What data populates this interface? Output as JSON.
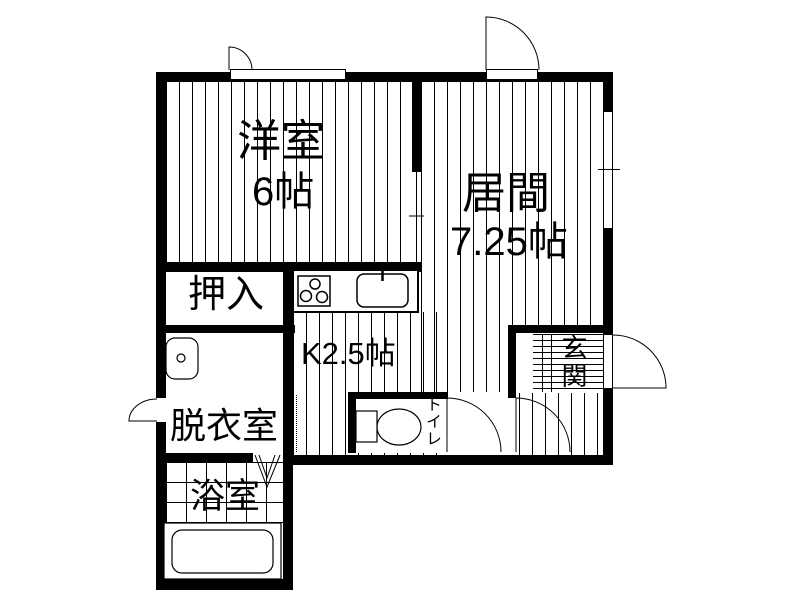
{
  "plan": {
    "type": "japanese-apartment-floor-plan",
    "rooms": {
      "western_room": {
        "label": "洋室",
        "size": "6帖"
      },
      "living_room": {
        "label": "居間",
        "size": "7.25帖"
      },
      "closet": {
        "label": "押入"
      },
      "kitchen": {
        "label": "K2.5帖"
      },
      "dressing_room": {
        "label": "脱衣室"
      },
      "bathroom": {
        "label": "浴室"
      },
      "entrance": {
        "label": "玄関"
      },
      "toilet": {
        "label": "トイレ"
      }
    },
    "colors": {
      "wall": "#000000",
      "background": "#ffffff",
      "line": "#000000"
    }
  }
}
